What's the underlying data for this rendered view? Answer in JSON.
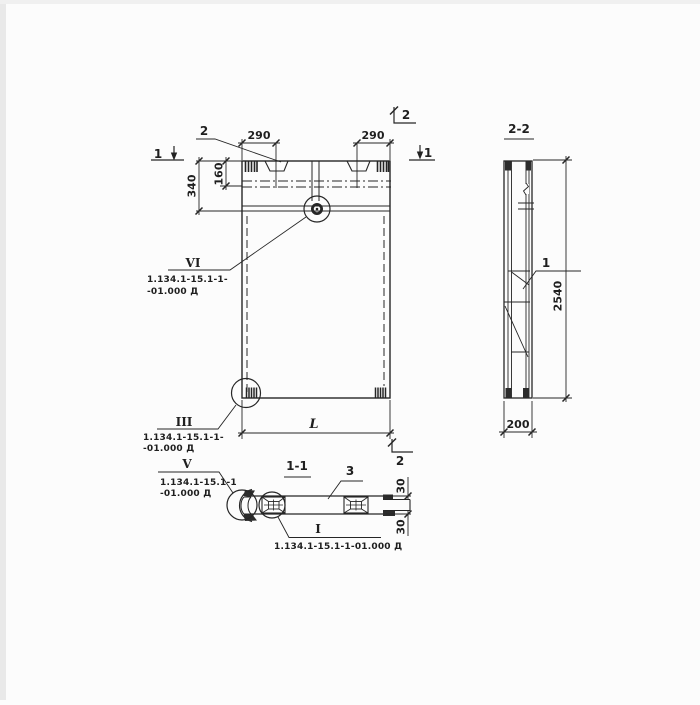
{
  "colors": {
    "ink": "#222222",
    "paper": "#fcfcfc"
  },
  "front_view": {
    "section_mark_1_left": "1",
    "section_mark_1_right": "1",
    "section_mark_2_top": "2",
    "section_mark_2_bottom": "2",
    "callout_2": "2",
    "dim_290_left": "290",
    "dim_290_right": "290",
    "dim_340": "340",
    "dim_160": "160",
    "dim_length": "L",
    "detail_vi": {
      "label": "VI",
      "ref_line1": "1.134.1-15.1-1-",
      "ref_line2": "-01.000 Д"
    },
    "detail_iii": {
      "label": "III",
      "ref_line1": "1.134.1-15.1-1-",
      "ref_line2": "-01.000 Д"
    }
  },
  "side_view": {
    "title": "2-2",
    "callout_1": "1",
    "dim_2540": "2540",
    "dim_200": "200"
  },
  "plan_section": {
    "title": "1-1",
    "callout_3": "3",
    "dim_30_top": "30",
    "dim_30_bottom": "30",
    "detail_v": {
      "label": "V",
      "ref_line1": "1.134.1-15.1-1",
      "ref_line2": "-01.000 Д"
    },
    "detail_i": {
      "label": "I",
      "ref": "1.134.1-15.1-1-01.000 Д"
    }
  }
}
